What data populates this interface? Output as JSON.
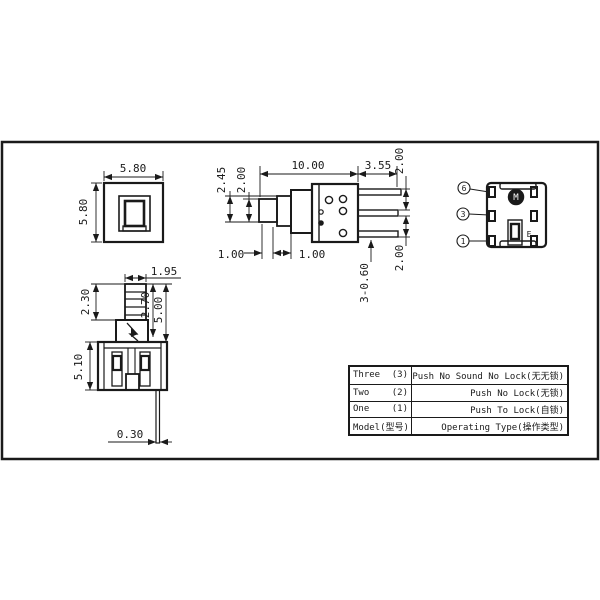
{
  "app": {
    "background": "#ffffff",
    "line_color": "#1a1a1a",
    "description": "Push button switch engineering drawing"
  },
  "front_view": {
    "dim_width": "5.80",
    "dim_height": "5.80"
  },
  "side_view": {
    "dim_length": "10.00",
    "dim_pin_length": "3.55",
    "dim_pin_pitch_top": "2.00",
    "dim_step_height": "2.45",
    "dim_tip_height": "2.00",
    "dim_step1": "1.00",
    "dim_step2": "1.00",
    "dim_pin_thickness": "3-0.60",
    "dim_pin_pitch_bottom": "2.00"
  },
  "bottom_view": {
    "pin_callouts": [
      "6",
      "3",
      "1"
    ],
    "rivet_mark": "M",
    "polarity_mark": "E"
  },
  "lower_front_view": {
    "dim_top_width": "1.95",
    "dim_knurl_height": "2.30",
    "dim_shaft_height": "2.70",
    "dim_plunger_height": "5.00",
    "dim_body_height": "5.10",
    "dim_pin_width": "0.30"
  },
  "spec_table": {
    "rows": [
      {
        "model": "Three",
        "code": "(3)",
        "type": "Push No Sound No Lock(无无锁)"
      },
      {
        "model": "Two",
        "code": "(2)",
        "type": "Push No Lock(无锁)"
      },
      {
        "model": "One",
        "code": "(1)",
        "type": "Push To Lock(自锁)"
      },
      {
        "model": "Model(型号)",
        "code": "",
        "type": "Operating Type(操作类型)"
      }
    ]
  }
}
